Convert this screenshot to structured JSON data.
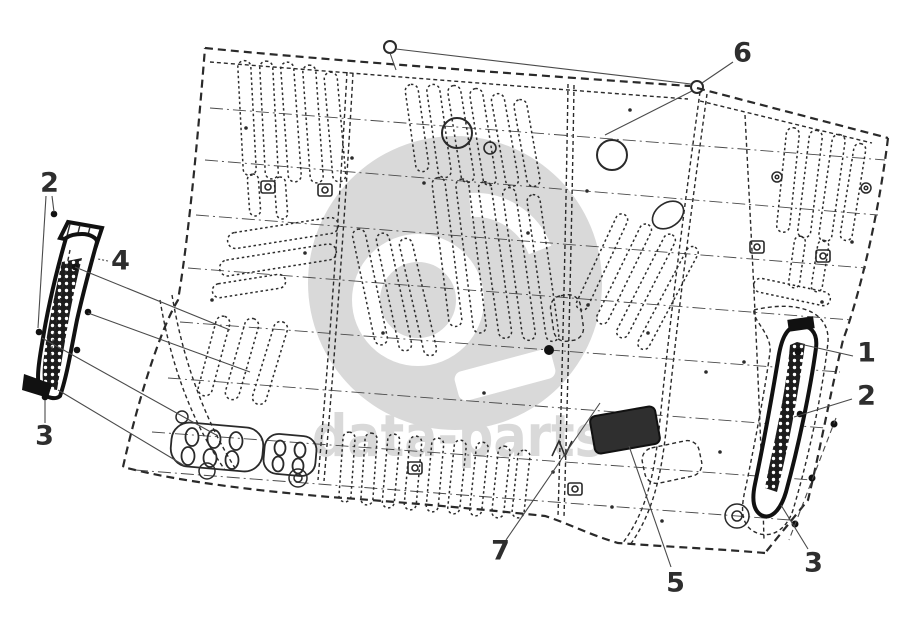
{
  "page": {
    "background": "#ffffff"
  },
  "watermark": {
    "text": "data-parts",
    "color": "#d9d9d9",
    "logo": "data-parts-logo-disc"
  },
  "diagram": {
    "type": "exploded-parts-diagram",
    "subject": "rear floor panel with sill trim parts",
    "ink_color": "#2a2a2a",
    "callout_color": "#2e2e2e",
    "callouts": [
      {
        "label": "2",
        "x": 49,
        "y": 183,
        "side": "left"
      },
      {
        "label": "4",
        "x": 120,
        "y": 261,
        "side": "left"
      },
      {
        "label": "3",
        "x": 44,
        "y": 436,
        "side": "left"
      },
      {
        "label": "6",
        "x": 742,
        "y": 53,
        "side": "top"
      },
      {
        "label": "1",
        "x": 866,
        "y": 353,
        "side": "right"
      },
      {
        "label": "2",
        "x": 866,
        "y": 396,
        "side": "right"
      },
      {
        "label": "3",
        "x": 813,
        "y": 563,
        "side": "right"
      },
      {
        "label": "7",
        "x": 500,
        "y": 551,
        "side": "bottom"
      },
      {
        "label": "5",
        "x": 675,
        "y": 583,
        "side": "bottom"
      }
    ]
  }
}
